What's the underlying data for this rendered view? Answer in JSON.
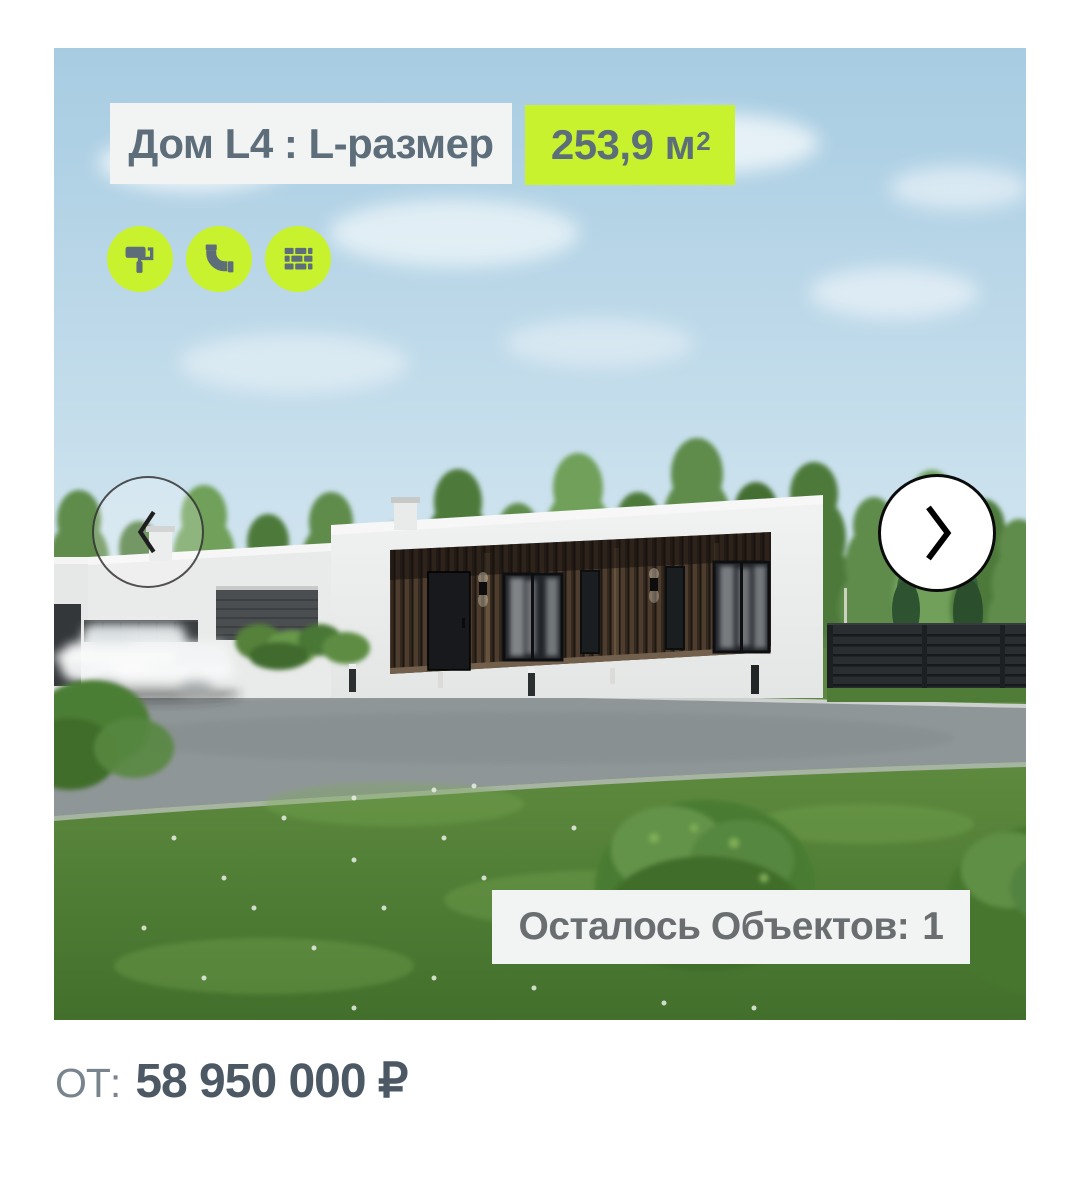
{
  "card": {
    "title": "Дом L4 : L-размер",
    "area": {
      "value": "253,9 м",
      "sup": "2"
    },
    "feature_icons": [
      "paint-roller-icon",
      "pipe-icon",
      "bricks-icon"
    ],
    "remaining": {
      "label": "Осталось Объектов:",
      "value": "1"
    }
  },
  "carousel": {
    "prev_icon": "chevron-left",
    "next_icon": "chevron-right"
  },
  "price": {
    "prefix": "ОТ:",
    "amount": "58 950 000 ₽"
  },
  "colors": {
    "accent_green": "#c9f22e",
    "title_text": "#5d6e7a",
    "badge_bg": "#f2f4f4",
    "remaining_text": "#6a6e70",
    "price_prefix": "#78858f",
    "price_amount": "#4c5964"
  }
}
